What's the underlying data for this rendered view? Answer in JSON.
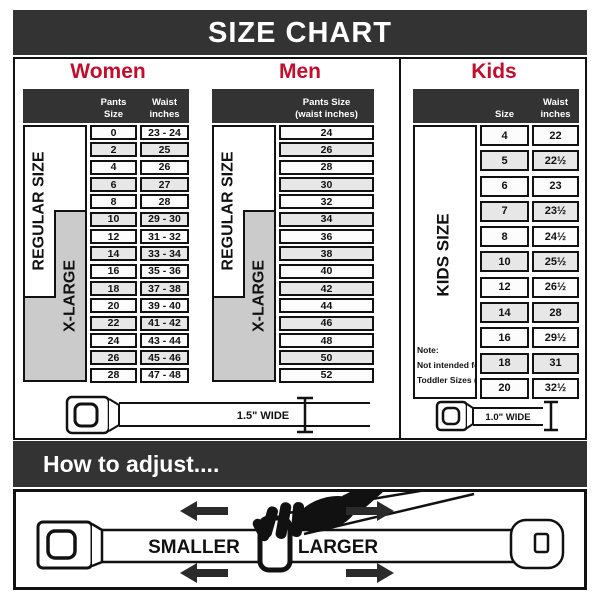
{
  "title": "SIZE CHART",
  "colors": {
    "bar_dark": "#333333",
    "accent_red": "#c10e2e",
    "xlarge_gray": "#cbcbcb",
    "row_alt": "#e7e7e7",
    "border": "#111111"
  },
  "women": {
    "heading": "Women",
    "col1_header": "Pants Size",
    "col2_header_line1": "Waist",
    "col2_header_line2": "inches",
    "regular_label": "REGULAR SIZE",
    "xlarge_label": "X-LARGE",
    "rows": [
      {
        "size": "0",
        "waist": "23 - 24"
      },
      {
        "size": "2",
        "waist": "25"
      },
      {
        "size": "4",
        "waist": "26"
      },
      {
        "size": "6",
        "waist": "27"
      },
      {
        "size": "8",
        "waist": "28"
      },
      {
        "size": "10",
        "waist": "29 - 30"
      },
      {
        "size": "12",
        "waist": "31 - 32"
      },
      {
        "size": "14",
        "waist": "33 - 34"
      },
      {
        "size": "16",
        "waist": "35 - 36"
      },
      {
        "size": "18",
        "waist": "37 - 38"
      },
      {
        "size": "20",
        "waist": "39 - 40"
      },
      {
        "size": "22",
        "waist": "41 - 42"
      },
      {
        "size": "24",
        "waist": "43 - 44"
      },
      {
        "size": "26",
        "waist": "45 - 46"
      },
      {
        "size": "28",
        "waist": "47 - 48"
      }
    ]
  },
  "men": {
    "heading": "Men",
    "col_header_line1": "Pants Size",
    "col_header_line2": "(waist inches)",
    "regular_label": "REGULAR SIZE",
    "xlarge_label": "X-LARGE",
    "rows": [
      "24",
      "26",
      "28",
      "30",
      "32",
      "34",
      "36",
      "38",
      "40",
      "42",
      "44",
      "46",
      "48",
      "50",
      "52"
    ]
  },
  "kids": {
    "heading": "Kids",
    "col1_header": "Size",
    "col2_header_line1": "Waist",
    "col2_header_line2": "inches",
    "label": "KIDS SIZE",
    "note_line1": "Note:",
    "note_line2": "Not intended for",
    "note_line3": "Toddler Sizes (T)",
    "rows": [
      {
        "size": "4",
        "waist": "22"
      },
      {
        "size": "5",
        "waist": "22½"
      },
      {
        "size": "6",
        "waist": "23"
      },
      {
        "size": "7",
        "waist": "23½"
      },
      {
        "size": "8",
        "waist": "24½"
      },
      {
        "size": "10",
        "waist": "25½"
      },
      {
        "size": "12",
        "waist": "26½"
      },
      {
        "size": "14",
        "waist": "28"
      },
      {
        "size": "16",
        "waist": "29½"
      },
      {
        "size": "18",
        "waist": "31"
      },
      {
        "size": "20",
        "waist": "32½"
      }
    ]
  },
  "belts": {
    "adult_width_label": "1.5\" WIDE",
    "kids_width_label": "1.0\" WIDE"
  },
  "adjust": {
    "heading": "How to adjust....",
    "smaller_label": "SMALLER",
    "larger_label": "LARGER"
  }
}
